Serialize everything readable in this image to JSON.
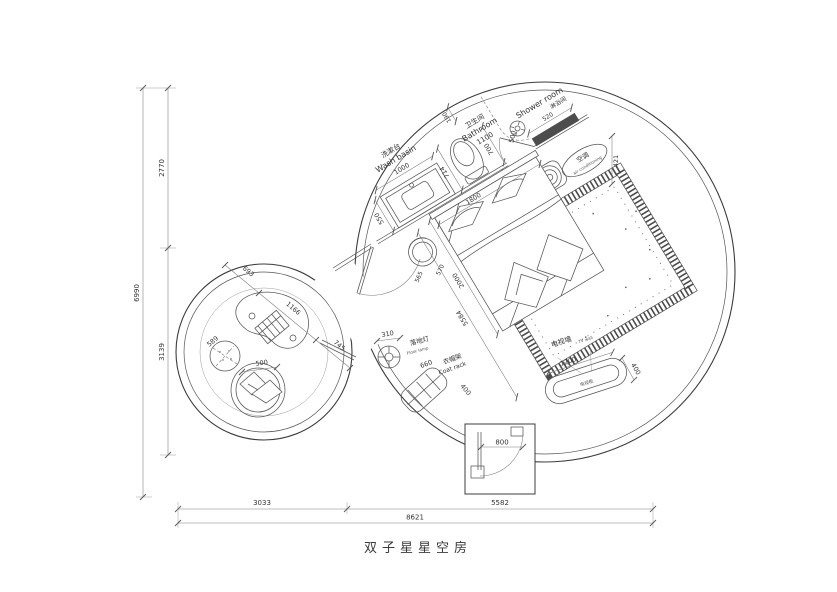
{
  "title": "双子星星空房",
  "colors": {
    "line": "#4a4a4a",
    "background": "#ffffff",
    "wall_fill": "#4d4d4d"
  },
  "outer_dims": {
    "height_total": "6990",
    "height_upper": "2770",
    "height_lower": "3139",
    "width_left": "3033",
    "width_right": "5582",
    "width_total": "8621"
  },
  "washbasin": {
    "label_cn": "洗漱台",
    "label_en": "Wash basin",
    "width": "1000",
    "depth": "550"
  },
  "bathroom": {
    "label_cn": "卫生间",
    "label_en": "Bathroom",
    "width": "1100",
    "d190": "190",
    "d700": "700",
    "door": "500",
    "d590": "590",
    "toilet": "714"
  },
  "shower": {
    "label_cn": "淋浴间",
    "label_en": "Shower room",
    "d520": "520"
  },
  "ac": {
    "label_cn": "空调",
    "label_en": "air conditioning",
    "d421": "421"
  },
  "bed": {
    "width": "1800",
    "length": "2000",
    "diag": "5584",
    "stool_a": "565",
    "stool_b": "570"
  },
  "tv": {
    "label_cn": "电视墙",
    "label_en": "TV wall",
    "cabinet_cn": "电视柜",
    "width": "1200",
    "depth": "400"
  },
  "floor_lamp": {
    "label_cn": "落地灯",
    "label_en": "Floor lamp",
    "dia": "310"
  },
  "coat_rack": {
    "label_cn": "衣帽架",
    "label_en": "Coat rack",
    "len": "660",
    "depth": "400"
  },
  "entry": {
    "door": "800"
  },
  "lounge": {
    "d693": "693",
    "d1166": "1166",
    "d745": "745",
    "pouf": "589",
    "chair": "500"
  }
}
